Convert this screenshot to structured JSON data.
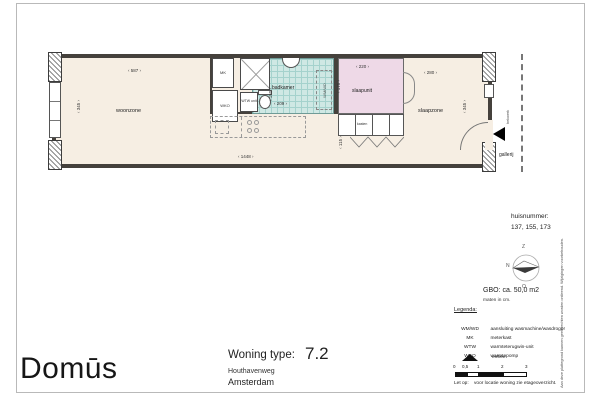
{
  "colors": {
    "floor": "#f6eee3",
    "wall": "#45413c",
    "badkamer_tile": "#cfe8e4",
    "slaapunit_fill": "#eed9e7"
  },
  "plan": {
    "rooms": {
      "woonzone": "woonzone",
      "badkamer": "badkamer",
      "slaapunit": "slaapunit",
      "slaapzone": "slaapzone",
      "gallerij": "gallerij"
    },
    "fixtures": {
      "mk": "MK",
      "wko": "WKO",
      "wtw": "WTW unit",
      "kasten": "kasten",
      "wmwd": "WM/WD"
    },
    "dims": {
      "woonzone_w": "587",
      "woonzone_h": "345",
      "badkamer_w": "209",
      "badkamer_h": "150",
      "slaapunit_w": "220",
      "slaapunit_h": "175",
      "kast_h": "115",
      "slaapzone_w": "280",
      "slaapzone_h": "345",
      "totaal_w": "1448"
    },
    "gallery_rail": "hekwerk"
  },
  "info": {
    "huisnummer_label": "huisnummer:",
    "huisnummer_values": "137, 155, 173",
    "compass": {
      "top": "Z",
      "left": "N",
      "bottom": "O"
    },
    "gbo": "GBO: ca. 50,0 m2",
    "units_note": "maten in cm."
  },
  "legend": {
    "title": "Legenda:",
    "items": [
      {
        "key": "WM/WD",
        "desc": "aansluiting wasmachine/wasdroger"
      },
      {
        "key": "MK",
        "desc": "meterkast"
      },
      {
        "key": "WTW",
        "desc": "warmteterugwin-unit"
      },
      {
        "key": "WKO",
        "desc": "warmtepomp"
      }
    ],
    "entree_label": "entree",
    "scale_ticks": [
      "0",
      "0,5",
      "1",
      "2",
      "3"
    ],
    "note_label": "Let op:",
    "note_text": "voor locatie woning zie etageoverzicht."
  },
  "title_block": {
    "type_label": "Woning type:",
    "type_value": "7.2",
    "street": "Houthavenweg",
    "city": "Amsterdam",
    "logo": "Domūs"
  },
  "disclaimer": "Aan deze plattegrond kunnen geen rechten worden ontleend. Wijzigingen voorbehouden."
}
